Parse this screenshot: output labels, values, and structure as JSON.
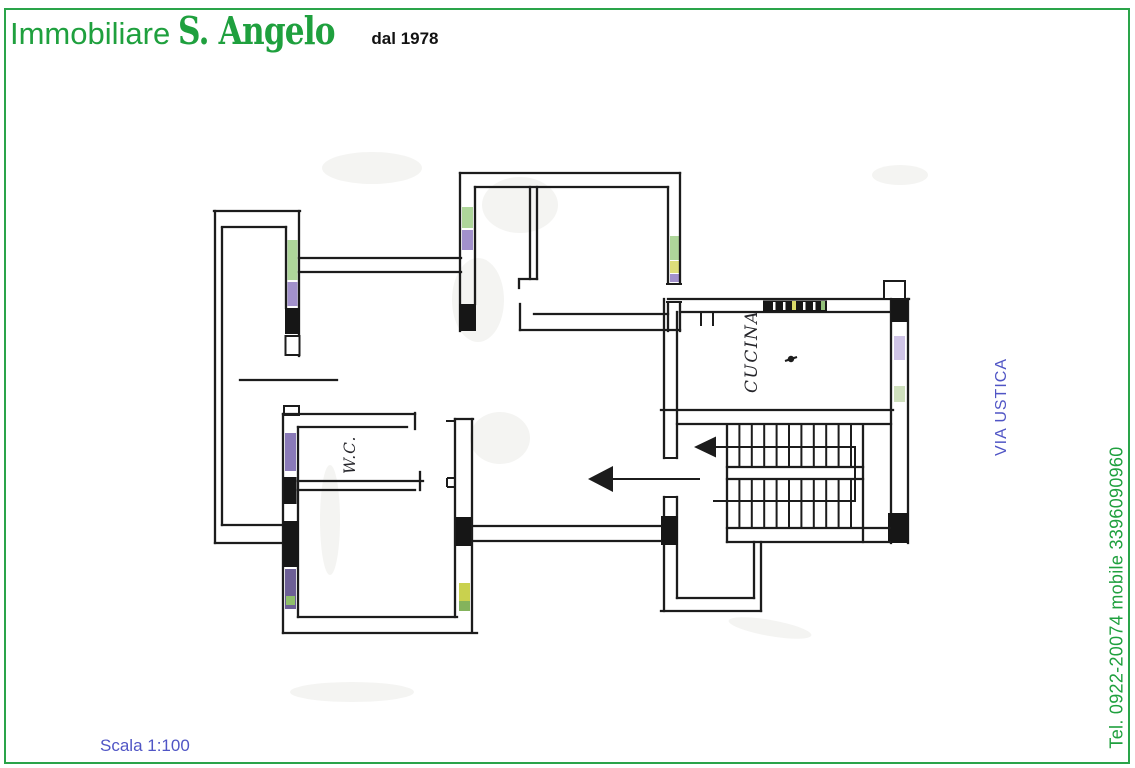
{
  "page": {
    "border_color": "#2aa44a",
    "background": "#ffffff"
  },
  "header": {
    "brand_prefix": "Immobiliare",
    "brand_name": "S. Angelo",
    "brand_suffix": "dal 1978",
    "brand_color": "#1fa03e",
    "suffix_color": "#121212"
  },
  "plan": {
    "labels": {
      "kitchen": "CUCINA",
      "wc": "W.C."
    },
    "ink_color": "#1c1c1c"
  },
  "annotations": {
    "street": "VIA USTICA",
    "street_color": "#5055c5",
    "phone": "Tel. 0922-20074 mobile 3396090960",
    "phone_color": "#1fa03e",
    "scale": "Scala 1:100",
    "scale_color": "#5055c5"
  }
}
